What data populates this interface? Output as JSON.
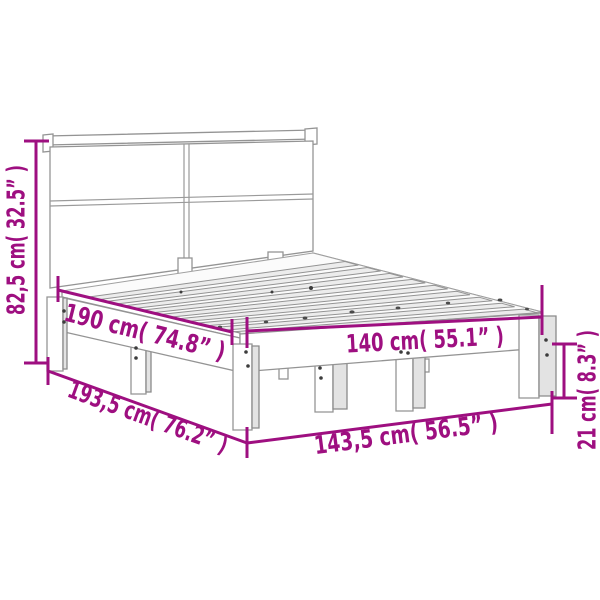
{
  "accent_color": "#9E0F80",
  "diagram": {
    "type": "product-dimension-diagram",
    "subject": "bed-frame-with-headboard",
    "labels": {
      "headboard_height": "82,5 cm( 32.5” )",
      "mattress_length": "190 cm( 74.8” )",
      "mattress_width": "140 cm( 55.1” )",
      "frame_length": "193,5 cm( 76.2” )",
      "frame_width": "143,5 cm( 56.5” )",
      "base_height": "21 cm( 8.3” )"
    }
  }
}
